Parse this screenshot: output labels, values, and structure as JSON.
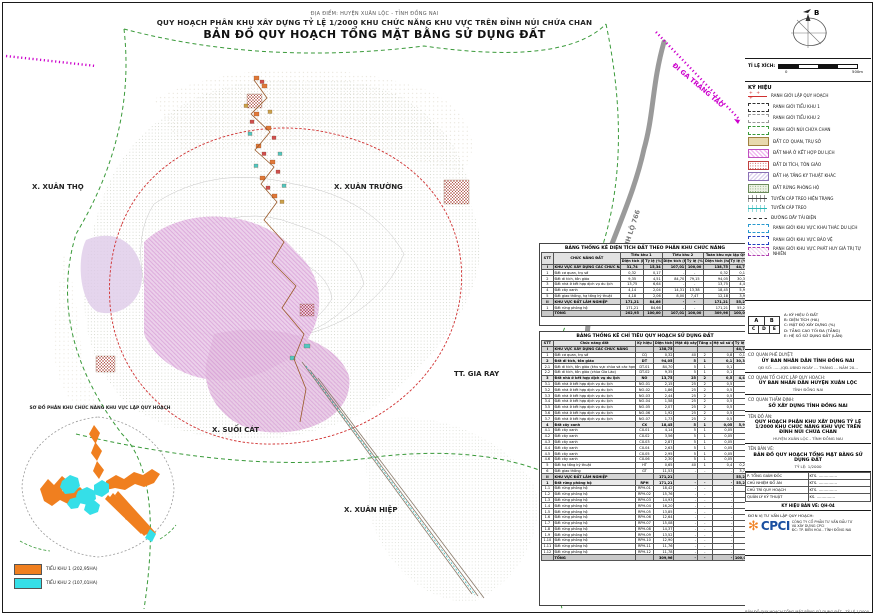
{
  "page": {
    "location_line": "ĐỊA ĐIỂM: HUYỆN XUÂN LỘC - TỈNH ĐỒNG NAI",
    "title_line1": "QUY HOẠCH PHÂN KHU XÂY DỰNG TỶ LỆ 1/2000 KHU CHỨC NĂNG KHU VỰC TRÊN ĐỈNH NÚI CHỨA CHAN",
    "title_line2": "BẢN ĐỒ QUY HOẠCH TỔNG MẶT BẰNG SỬ DỤNG ĐẤT"
  },
  "colors": {
    "boundary_red": "#D03030",
    "boundary_green": "#3A9A3A",
    "rail_magenta": "#CC00CC",
    "road_gray": "#999999",
    "inset_orange": "#F07F1F",
    "inset_cyan": "#35DFE8",
    "logo_orange": "#F08020",
    "logo_blue": "#1A4FA0"
  },
  "map": {
    "labels": {
      "xuan_tho": "X. XUÂN THỌ",
      "xuan_truong": "X. XUÂN TRƯỜNG",
      "gia_ray": "TT. GIA RAY",
      "suoi_cat": "X. SUỐI CÁT",
      "xuan_hiep": "X. XUÂN HIỆP",
      "road": "TỈNH LỘ 766",
      "rail": "ĐI GA TRẢNG TÁO"
    }
  },
  "compass": {
    "north_label": "B"
  },
  "scalebar": {
    "label": "TỈ LỆ XÍCH:",
    "start": "0",
    "end": "500m"
  },
  "legend": {
    "title": "KÝ HIỆU",
    "items": [
      {
        "label": "RANH GIỚI LẬP QUY HOẠCH",
        "sw": "sw1"
      },
      {
        "label": "RANH GIỚI TIỂU KHU 1",
        "sw": "sw2"
      },
      {
        "label": "RANH GIỚI TIỂU KHU 2",
        "sw": "sw3"
      },
      {
        "label": "RANH GIỚI NÚI CHỨA CHAN",
        "sw": "sw4"
      },
      {
        "label": "ĐẤT CƠ QUAN, TRỤ SỞ",
        "sw": "sw5"
      },
      {
        "label": "ĐẤT NHÀ Ở KẾT HỢP DU LỊCH",
        "sw": "sw6"
      },
      {
        "label": "ĐẤT DI TÍCH, TÔN GIÁO",
        "sw": "sw7"
      },
      {
        "label": "ĐẤT HẠ TẦNG KỸ THUẬT KHÁC",
        "sw": "sw8"
      },
      {
        "label": "ĐẤT RỪNG PHÒNG HỘ",
        "sw": "sw9"
      },
      {
        "label": "TUYẾN CÁP TREO HIỆN TRẠNG",
        "sw": "sw10"
      },
      {
        "label": "TUYẾN CÁP TREO",
        "sw": "sw11"
      },
      {
        "label": "ĐƯỜNG DÂY TẢI ĐIỆN",
        "sw": "sw12"
      },
      {
        "label": "RANH GIỚI KHU VỰC KHAI THÁC DU LỊCH",
        "sw": "sw13"
      },
      {
        "label": "RANH GIỚI KHU VỰC BẢO VỆ",
        "sw": "sw14"
      },
      {
        "label": "RANH GIỚI KHU VỰC PHÁT HUY GIÁ TRỊ TỰ NHIÊN",
        "sw": "sw15"
      }
    ]
  },
  "abc": {
    "top": [
      "A",
      "B"
    ],
    "bottom": [
      "C",
      "D",
      "E"
    ],
    "items": [
      "A: KÝ HIỆU Ô ĐẤT",
      "B: DIỆN TÍCH (HA)",
      "C: MẬT ĐỘ XÂY DỰNG (%)",
      "D: TẦNG CAO TỐI ĐA (TẦNG)",
      "E: HỆ SỐ SỬ DỤNG ĐẤT (LẦN)"
    ]
  },
  "table1": {
    "title": "BẢNG THỐNG KÊ DIỆN TÍCH ĐẤT THEO PHÂN KHU CHỨC NĂNG",
    "h": {
      "stt": "STT",
      "func": "CHỨC NĂNG ĐẤT",
      "g1": "Tiểu khu 1",
      "g2": "Tiểu khu 2",
      "g3": "Toàn khu vực lập QH",
      "area": "Diện tích (ha)",
      "pct": "Tỷ lệ (%)"
    },
    "rows": [
      {
        "cls": "sec",
        "c": [
          "I",
          "KHU VỰC XÂY DỰNG CÁC CHỨC NĂNG",
          "31,74",
          "15,34",
          "107,01",
          "100,00",
          "138,75",
          "44,76"
        ]
      },
      {
        "c": [
          "1",
          "Đất cơ quan, trụ sở",
          "0,32",
          "0,17",
          "-",
          "-",
          "0,32",
          "0,10"
        ]
      },
      {
        "c": [
          "2",
          "Đất di tích, tôn giáo",
          "9,35",
          "4,51",
          "84,70",
          "79,15",
          "94,05",
          "30,34"
        ]
      },
      {
        "c": [
          "3",
          "Đất nhà ở kết hợp dịch vụ du lịch",
          "13,75",
          "6,64",
          "-",
          "-",
          "13,75",
          "4,44"
        ]
      },
      {
        "c": [
          "4",
          "Đất cây xanh",
          "4,14",
          "2,04",
          "14,31",
          "13,38",
          "18,45",
          "5,95"
        ]
      },
      {
        "c": [
          "5",
          "Đất giao thông, hạ tầng kỹ thuật",
          "4,18",
          "2,06",
          "8,00",
          "7,47",
          "12,18",
          "3,93"
        ]
      },
      {
        "cls": "sec",
        "c": [
          "II",
          "KHU VỰC ĐẤT LÂM NGHIỆP",
          "171,21",
          "84,66",
          "-",
          "-",
          "171,21",
          "55,24"
        ]
      },
      {
        "c": [
          "1",
          "Đất rừng phòng hộ",
          "171,21",
          "84,66",
          "-",
          "-",
          "171,21",
          "55,24"
        ]
      },
      {
        "cls": "tot",
        "c": [
          "",
          "TỔNG",
          "202,95",
          "100,00",
          "107,01",
          "100,00",
          "309,96",
          "100,00"
        ]
      }
    ]
  },
  "table2": {
    "title": "BẢNG THỐNG KÊ CHỈ TIÊU QUY HOẠCH SỬ DỤNG ĐẤT",
    "headers": [
      "STT",
      "Chức năng đất",
      "Ký hiệu",
      "Diện tích (ha)",
      "Mật độ xây dựng tối đa (%)",
      "Tầng cao (tầng)",
      "Hệ số sử dụng đất (lần)",
      "Tỷ lệ (%)"
    ],
    "rows": [
      {
        "cls": "sec",
        "c": [
          "I",
          "KHU VỰC XÂY DỰNG CÁC CHỨC NĂNG",
          "",
          "138,75",
          "",
          "",
          "",
          "44,76"
        ]
      },
      {
        "c": [
          "1",
          "Đất cơ quan, trụ sở",
          "CQ",
          "0,32",
          "40",
          "2",
          "0,8",
          "0,10"
        ]
      },
      {
        "cls": "subsec",
        "c": [
          "2",
          "Đất di tích, tôn giáo",
          "DT",
          "94,05",
          "5",
          "1",
          "0,1",
          "30,34"
        ]
      },
      {
        "c": [
          "2.1",
          "Đất di tích, tôn giáo (khu vực chùa và các hạng mục tín ngưỡng trên đỉnh núi Chứa Chan)",
          "DT-01",
          "84,70",
          "5",
          "1",
          "0,1",
          ""
        ]
      },
      {
        "c": [
          "2.2",
          "Đất di tích, tôn giáo (chùa Gia Lào)",
          "DT-02",
          "9,35",
          "5",
          "1",
          "0,1",
          ""
        ]
      },
      {
        "cls": "subsec",
        "c": [
          "3",
          "Đất nhà ở kết hợp dịch vụ du lịch",
          "NO",
          "13,75",
          "25",
          "2",
          "0,5",
          "4,44"
        ]
      },
      {
        "c": [
          "3.1",
          "Đất nhà ở kết hợp dịch vụ du lịch",
          "NO-01",
          "2,15",
          "25",
          "2",
          "0,5",
          ""
        ]
      },
      {
        "c": [
          "3.2",
          "Đất nhà ở kết hợp dịch vụ du lịch",
          "NO-02",
          "1,86",
          "25",
          "2",
          "0,5",
          ""
        ]
      },
      {
        "c": [
          "3.3",
          "Đất nhà ở kết hợp dịch vụ du lịch",
          "NO-03",
          "2,44",
          "25",
          "2",
          "0,5",
          ""
        ]
      },
      {
        "c": [
          "3.4",
          "Đất nhà ở kết hợp dịch vụ du lịch",
          "NO-04",
          "1,58",
          "25",
          "2",
          "0,5",
          ""
        ]
      },
      {
        "c": [
          "3.5",
          "Đất nhà ở kết hợp dịch vụ du lịch",
          "NO-05",
          "2,07",
          "25",
          "2",
          "0,5",
          ""
        ]
      },
      {
        "c": [
          "3.6",
          "Đất nhà ở kết hợp dịch vụ du lịch",
          "NO-06",
          "1,92",
          "25",
          "2",
          "0,5",
          ""
        ]
      },
      {
        "c": [
          "3.7",
          "Đất nhà ở kết hợp dịch vụ du lịch",
          "NO-07",
          "1,73",
          "25",
          "2",
          "0,5",
          ""
        ]
      },
      {
        "cls": "subsec",
        "c": [
          "4",
          "Đất cây xanh",
          "CX",
          "18,45",
          "5",
          "1",
          "0,05",
          "5,95"
        ]
      },
      {
        "c": [
          "4.1",
          "Đất cây xanh",
          "CX-01",
          "4,14",
          "5",
          "1",
          "0,05",
          ""
        ]
      },
      {
        "c": [
          "4.2",
          "Đất cây xanh",
          "CX-02",
          "3,56",
          "5",
          "1",
          "0,05",
          ""
        ]
      },
      {
        "c": [
          "4.3",
          "Đất cây xanh",
          "CX-03",
          "2,87",
          "5",
          "1",
          "0,05",
          ""
        ]
      },
      {
        "c": [
          "4.4",
          "Đất cây xanh",
          "CX-04",
          "2,63",
          "5",
          "1",
          "0,05",
          ""
        ]
      },
      {
        "c": [
          "4.5",
          "Đất cây xanh",
          "CX-05",
          "2,95",
          "5",
          "1",
          "0,05",
          ""
        ]
      },
      {
        "c": [
          "4.6",
          "Đất cây xanh",
          "CX-06",
          "2,30",
          "5",
          "1",
          "0,05",
          ""
        ]
      },
      {
        "c": [
          "5",
          "Đất hạ tầng kỹ thuật",
          "HT",
          "0,65",
          "40",
          "1",
          "0,4",
          "0,21"
        ]
      },
      {
        "c": [
          "6",
          "Đất giao thông",
          "GT",
          "11,53",
          "-",
          "-",
          "-",
          "3,72"
        ]
      },
      {
        "cls": "sec",
        "c": [
          "II",
          "KHU VỰC ĐẤT LÂM NGHIỆP",
          "",
          "171,21",
          "",
          "",
          "",
          "55,24"
        ]
      },
      {
        "cls": "subsec",
        "c": [
          "1",
          "Đất rừng phòng hộ",
          "RPH",
          "171,21",
          "-",
          "-",
          "-",
          "55,24"
        ]
      },
      {
        "c": [
          "1.1",
          "Đất rừng phòng hộ",
          "RPH-01",
          "18,42",
          "-",
          "-",
          "-",
          ""
        ]
      },
      {
        "c": [
          "1.2",
          "Đất rừng phòng hộ",
          "RPH-02",
          "15,76",
          "-",
          "-",
          "-",
          ""
        ]
      },
      {
        "c": [
          "1.3",
          "Đất rừng phòng hộ",
          "RPH-03",
          "14,93",
          "-",
          "-",
          "-",
          ""
        ]
      },
      {
        "c": [
          "1.4",
          "Đất rừng phòng hộ",
          "RPH-04",
          "16,20",
          "-",
          "-",
          "-",
          ""
        ]
      },
      {
        "c": [
          "1.5",
          "Đất rừng phòng hộ",
          "RPH-05",
          "13,85",
          "-",
          "-",
          "-",
          ""
        ]
      },
      {
        "c": [
          "1.6",
          "Đất rừng phòng hộ",
          "RPH-06",
          "12,64",
          "-",
          "-",
          "-",
          ""
        ]
      },
      {
        "c": [
          "1.7",
          "Đất rừng phòng hộ",
          "RPH-07",
          "15,08",
          "-",
          "-",
          "-",
          ""
        ]
      },
      {
        "c": [
          "1.8",
          "Đất rừng phòng hộ",
          "RPH-08",
          "14,37",
          "-",
          "-",
          "-",
          ""
        ]
      },
      {
        "c": [
          "1.9",
          "Đất rừng phòng hộ",
          "RPH-09",
          "13,52",
          "-",
          "-",
          "-",
          ""
        ]
      },
      {
        "c": [
          "1.10",
          "Đất rừng phòng hộ",
          "RPH-10",
          "12,90",
          "-",
          "-",
          "-",
          ""
        ]
      },
      {
        "c": [
          "1.11",
          "Đất rừng phòng hộ",
          "RPH-11",
          "11,76",
          "-",
          "-",
          "-",
          ""
        ]
      },
      {
        "c": [
          "1.12",
          "Đất rừng phòng hộ",
          "RPH-12",
          "11,78",
          "-",
          "-",
          "-",
          ""
        ]
      },
      {
        "cls": "tot",
        "c": [
          "",
          "TỔNG",
          "",
          "309,96",
          "-",
          "-",
          "-",
          "100,00"
        ]
      }
    ]
  },
  "inset": {
    "title": "SƠ ĐỒ PHÂN KHU CHỨC NĂNG KHU VỰC LẬP QUY HOẠCH",
    "legend": [
      {
        "label": "TIỂU KHU 1 (202,95HA)",
        "color": "#F07F1F"
      },
      {
        "label": "TIỂU KHU 2 (107,01HA)",
        "color": "#35DFE8"
      }
    ]
  },
  "titleblock": {
    "s1": {
      "h": "CƠ QUAN PHÊ DUYỆT:",
      "b": "ỦY BAN NHÂN DÂN TỈNH ĐỒNG NAI",
      "n": "QĐ SỐ: ....../QĐ-UBND NGÀY ... THÁNG ... NĂM 20..."
    },
    "s2": {
      "h": "CƠ QUAN TỔ CHỨC LẬP QUY HOẠCH:",
      "b": "ỦY BAN NHÂN DÂN HUYỆN XUÂN LỘC",
      "n": "TỈNH ĐỒNG NAI"
    },
    "s3": {
      "h": "CƠ QUAN THẨM ĐỊNH:",
      "b": "SỞ XÂY DỰNG TỈNH ĐỒNG NAI",
      "n": ""
    },
    "s4": {
      "h": "TÊN ĐỒ ÁN:",
      "b": "QUY HOẠCH PHÂN KHU XÂY DỰNG TỶ LỆ 1/2000 KHU CHỨC NĂNG KHU VỰC TRÊN ĐỈNH NÚI CHỨA CHAN",
      "n": "HUYỆN XUÂN LỘC - TỈNH ĐỒNG NAI"
    },
    "s5": {
      "h": "TÊN BẢN VẼ:",
      "b": "BẢN ĐỒ QUY HOẠCH TỔNG MẶT BẰNG SỬ DỤNG ĐẤT",
      "n": "TỶ LỆ: 1/2000"
    }
  },
  "signatures": {
    "rows": [
      {
        "role": "P. TỔNG GIÁM ĐỐC",
        "name": "KTS. ……………"
      },
      {
        "role": "CHỦ NHIỆM ĐỒ ÁN",
        "name": "KTS. ……………"
      },
      {
        "role": "CHỦ TRÌ QUY HOẠCH",
        "name": "KTS. ……………"
      },
      {
        "role": "QUẢN LÝ KỸ THUẬT",
        "name": "KS. ……………"
      }
    ],
    "code": "KÝ HIỆU BẢN VẼ: QH-04"
  },
  "firm": {
    "unit_label": "ĐƠN VỊ TƯ VẤN LẬP QUY HOẠCH:",
    "logo_text": "CPCI",
    "lines": [
      "CÔNG TY CỔ PHẦN TƯ VẤN ĐẦU TƯ",
      "VÀ XÂY DỰNG CPCI",
      "ĐC: TP. BIÊN HÒA - TỈNH ĐỒNG NAI"
    ]
  },
  "footer": {
    "note": "BẢN ĐỒ QUY HOẠCH TỔNG MẶT BẰNG SỬ DỤNG ĐẤT - TỶ LỆ 1/2000"
  }
}
